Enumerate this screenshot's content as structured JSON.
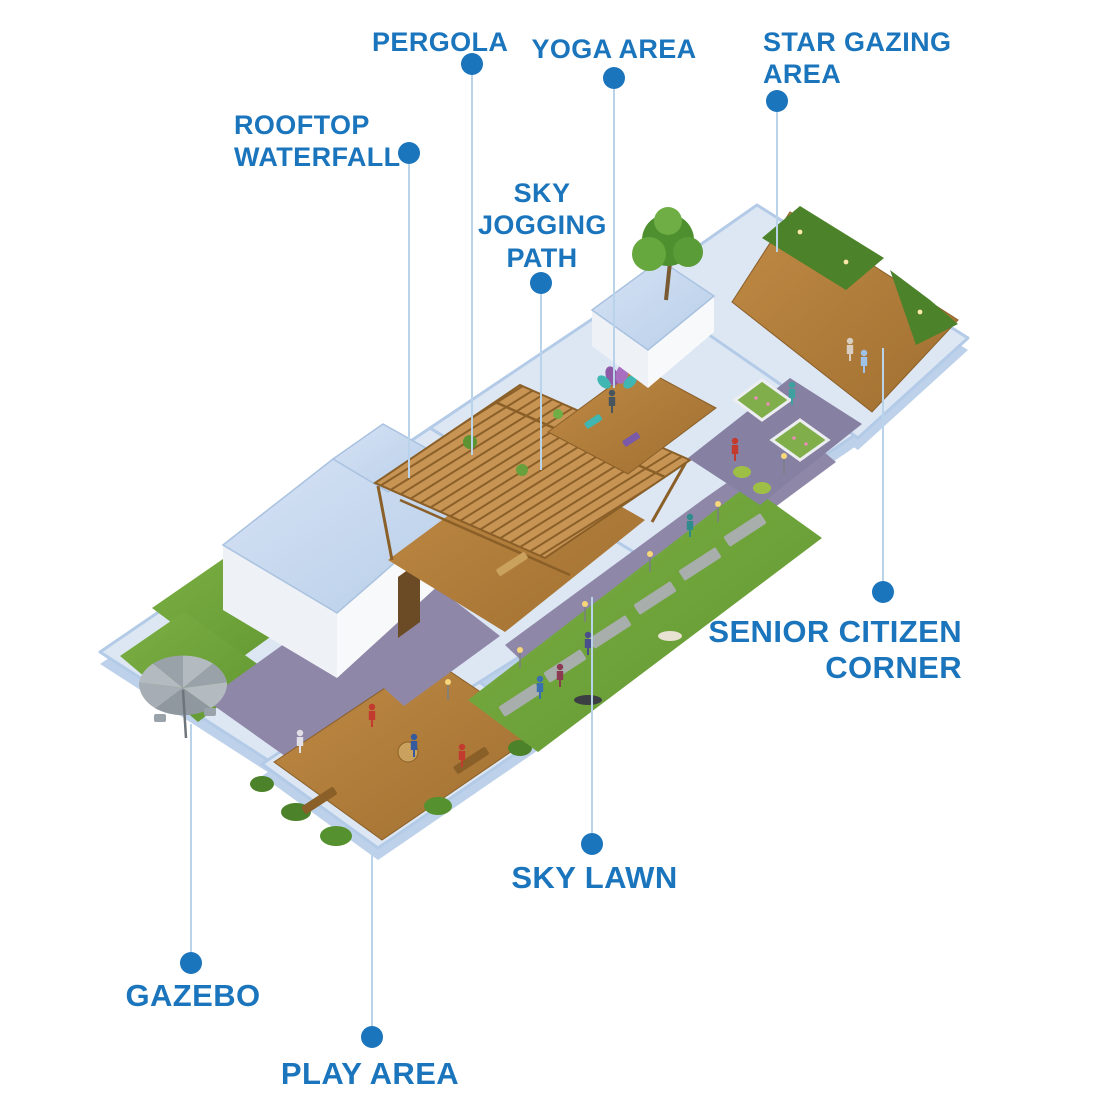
{
  "figure": {
    "type": "rooftop-amenities-isometric-plan",
    "background": "#ffffff"
  },
  "labels": [
    {
      "id": "pergola",
      "text": "PERGOLA"
    },
    {
      "id": "rooftop-waterfall",
      "text": "ROOFTOP WATERFALL"
    },
    {
      "id": "sky-jogging-path",
      "text": "SKY JOGGING PATH"
    },
    {
      "id": "yoga-area",
      "text": "YOGA AREA"
    },
    {
      "id": "star-gazing-area",
      "text": "STAR GAZING AREA"
    },
    {
      "id": "senior-citizen-corner",
      "text": "SENIOR CITIZEN CORNER"
    },
    {
      "id": "sky-lawn",
      "text": "SKY LAWN"
    },
    {
      "id": "gazebo",
      "text": "GAZEBO"
    },
    {
      "id": "play-area",
      "text": "PLAY AREA"
    }
  ],
  "marker": {
    "shape": "filled-circle",
    "connector": "thin-vertical-line"
  },
  "colors": {
    "label_blue": "#1b75bc",
    "dot_blue": "#1b75bc",
    "line_blue": "#b9d4ea",
    "slab_blue": "#dde7f4",
    "parapet_blue": "#b3cbe7",
    "roof_blue": "#c5d8ee",
    "wall_white": "#f4f5f8",
    "deck_wood": "#b5823e",
    "pergola_wood": "#c79454",
    "lawn_green": "#6fa43c",
    "hedge_green": "#4c8229",
    "path_purple": "#8f87a8",
    "umbrella_gray": "#a7aeb5",
    "flowerbed_green": "#7fae4a"
  }
}
